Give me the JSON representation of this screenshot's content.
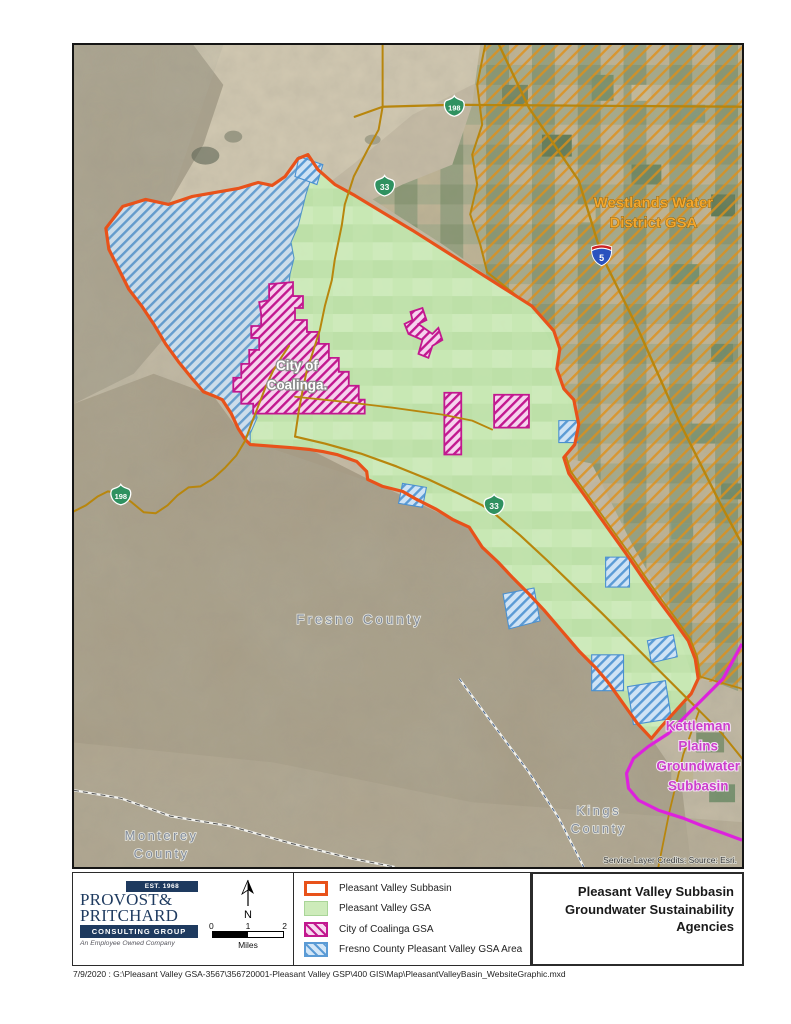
{
  "map": {
    "labels": {
      "westlands": [
        "Westlands Water",
        "District GSA"
      ],
      "coalinga": [
        "City of",
        "Coalinga."
      ],
      "kettleman": [
        "Kettleman",
        "Plains",
        "Groundwater",
        "Subbasin"
      ],
      "fresno_county": "Fresno County",
      "monterey_county": [
        "Monterey",
        "County"
      ],
      "kings_county": [
        "Kings",
        "County"
      ],
      "credits": "Service Layer Credits: Source: Esri."
    },
    "shields": {
      "sr198_top": "198",
      "sr33_top": "33",
      "sr198_west": "198",
      "sr33_mid": "33",
      "i5": "5"
    }
  },
  "legend": {
    "items": [
      {
        "label": "Pleasant Valley Subbasin",
        "swatch": "orange-outline"
      },
      {
        "label": "Pleasant Valley GSA",
        "swatch": "green-fill"
      },
      {
        "label": "City of Coalinga GSA",
        "swatch": "magenta-hatch"
      },
      {
        "label": "Fresno County Pleasant Valley GSA Area",
        "swatch": "blue-hatch"
      }
    ]
  },
  "title": {
    "lines": [
      "Pleasant Valley Subbasin",
      "Groundwater Sustainability",
      "Agencies"
    ]
  },
  "logo": {
    "est": "EST. 1968",
    "name1": "PROVOST&",
    "name2": "PRITCHARD",
    "group": "CONSULTING GROUP",
    "tagline": "An Employee Owned Company"
  },
  "scalebar": {
    "ticks": [
      "0",
      "1",
      "2"
    ],
    "unit": "Miles",
    "north": "N"
  },
  "footer": {
    "path": "7/9/2020 : G:\\Pleasant Valley GSA-3567\\356720001-Pleasant Valley GSP\\400 GIS\\Map\\PleasantValleyBasin_WebsiteGraphic.mxd"
  },
  "colors": {
    "subbasin_orange": "#E8521A",
    "gsa_green": "#CDEBBA",
    "coalinga_magenta": "#C2188F",
    "fresno_blue": "#5B9BD5",
    "westlands_gold": "#B8860D",
    "westlands_label": "#F2A72E",
    "kettleman_magenta": "#DD22DD",
    "logo_navy": "#1E3A5F"
  }
}
